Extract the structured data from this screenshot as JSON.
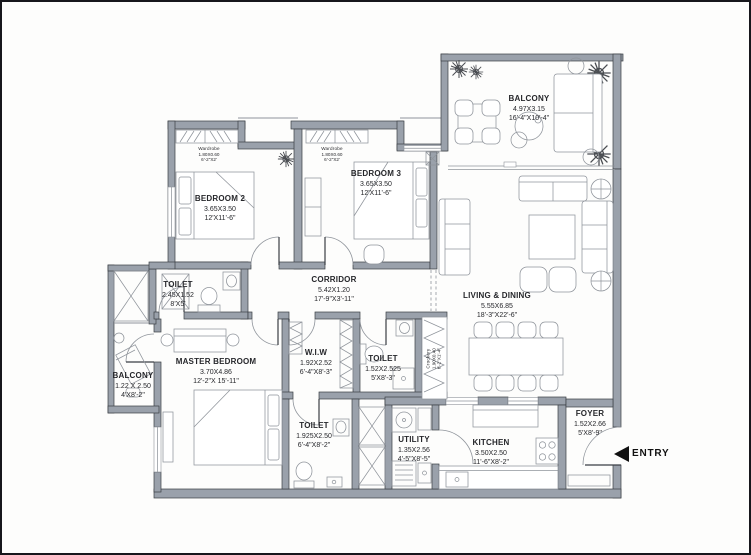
{
  "colors": {
    "wall": "#9aa1ab",
    "wallstroke": "#3a3e44",
    "line": "#8f949b",
    "ink": "#26272b"
  },
  "plan": {
    "entry_label": "ENTRY",
    "rooms": {
      "bedroom2": {
        "name": "BEDROOM 2",
        "dim_m": "3.65X3.50",
        "dim_ft": "12'X11'-6\""
      },
      "bedroom3": {
        "name": "BEDROOM 3",
        "dim_m": "3.65X3.50",
        "dim_ft": "12'X11'-6\""
      },
      "balcony_top": {
        "name": "BALCONY",
        "dim_m": "4.97X3.15",
        "dim_ft": "16'-4\"X10'-4\""
      },
      "living_dining": {
        "name": "LIVING & DINING",
        "dim_m": "5.55X6.85",
        "dim_ft": "18'-3\"X22'-6\""
      },
      "corridor": {
        "name": "CORRIDOR",
        "dim_m": "5.42X1.20",
        "dim_ft": "17'-9\"X3'-11\""
      },
      "toilet_master": {
        "name": "TOILET",
        "dim_m": "2.45X1.52",
        "dim_ft": "8'X5'"
      },
      "master_bedroom": {
        "name": "MASTER BEDROOM",
        "dim_m": "3.70X4.86",
        "dim_ft": "12'-2\"X 15'-11\""
      },
      "balcony_left": {
        "name": "BALCONY",
        "dim_m": "1.22 X 2.50",
        "dim_ft": "4'X8'-2\""
      },
      "wiw": {
        "name": "W.I.W",
        "dim_m": "1.92X2.52",
        "dim_ft": "6'-4\"X8'-3\""
      },
      "toilet_mid": {
        "name": "TOILET",
        "dim_m": "1.52X2.525",
        "dim_ft": "5'X8'-3\""
      },
      "toilet_common": {
        "name": "TOILET",
        "dim_m": "1.925X2.50",
        "dim_ft": "6'-4\"X8'-2\""
      },
      "utility": {
        "name": "UTILITY",
        "dim_m": "1.35X2.56",
        "dim_ft": "4'-5\"X8'-5\""
      },
      "kitchen": {
        "name": "KITCHEN",
        "dim_m": "3.50X2.50",
        "dim_ft": "11'-6\"X8'-2\""
      },
      "foyer": {
        "name": "FOYER",
        "dim_m": "1.52X2.66",
        "dim_ft": "5'X8'-9\""
      },
      "crockery": {
        "name": "Crockery",
        "dim_m": "1.90X0.40",
        "dim_ft": "6'-2\"X1'-4\""
      },
      "wardrobe2": {
        "name": "Wardrobe",
        "dim_m": "1.80X0.60",
        "dim_ft": "6'-2\"X2'"
      },
      "wardrobe3": {
        "name": "Wardrobe",
        "dim_m": "1.80X0.60",
        "dim_ft": "6'-2\"X2'"
      }
    }
  }
}
